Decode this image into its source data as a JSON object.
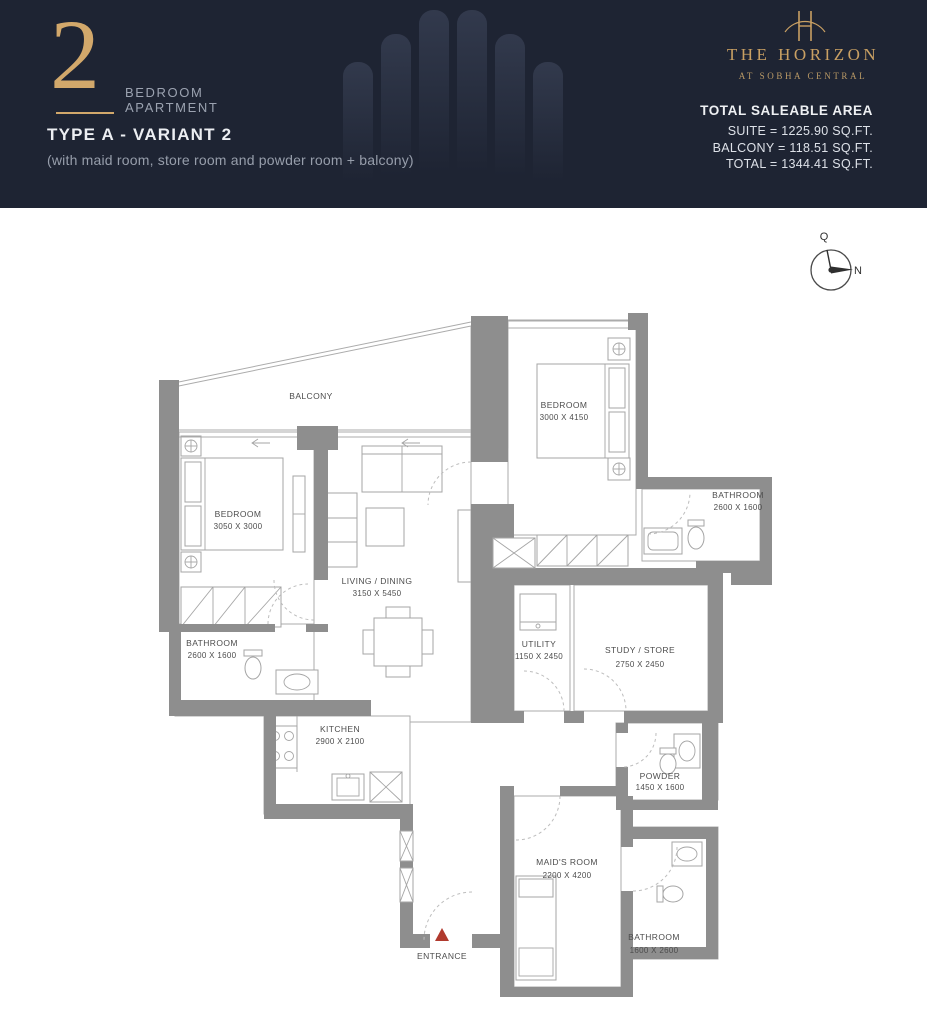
{
  "header": {
    "unit_number": "2",
    "unit_type_line1": "BEDROOM",
    "unit_type_line2": "APARTMENT",
    "variant": "TYPE A - VARIANT 2",
    "subtitle": "(with maid room, store room and powder room  + balcony)",
    "brand": {
      "name": "THE HORIZON",
      "tagline": "AT SOBHA CENTRAL"
    },
    "area": {
      "title": "TOTAL SALEABLE AREA",
      "suite": "SUITE = 1225.90 SQ.FT.",
      "balcony": "BALCONY = 118.51 SQ.FT.",
      "total": "TOTAL = 1344.41 SQ.FT."
    },
    "colors": {
      "background": "#1e2433",
      "gold": "#c9a063"
    }
  },
  "compass": {
    "top_label": "Q",
    "right_label": "N"
  },
  "plan": {
    "entrance_label": "ENTRANCE",
    "colors": {
      "wall": "#8e8e8e",
      "entrance_marker": "#b03a2e"
    },
    "rooms": [
      {
        "id": "balcony",
        "name": "BALCONY",
        "dims": ""
      },
      {
        "id": "bedroom-1",
        "name": "BEDROOM",
        "dims": "3050 X 3000"
      },
      {
        "id": "bathroom-1",
        "name": "BATHROOM",
        "dims": "2600 X 1600"
      },
      {
        "id": "living-dining",
        "name": "LIVING / DINING",
        "dims": "3150 X 5450"
      },
      {
        "id": "kitchen",
        "name": "KITCHEN",
        "dims": "2900 X 2100"
      },
      {
        "id": "bedroom-2",
        "name": "BEDROOM",
        "dims": "3000 X 4150"
      },
      {
        "id": "bathroom-2",
        "name": "BATHROOM",
        "dims": "2600 X 1600"
      },
      {
        "id": "utility",
        "name": "UTILITY",
        "dims": "1150 X 2450"
      },
      {
        "id": "study-store",
        "name": "STUDY / STORE",
        "dims": "2750 X 2450"
      },
      {
        "id": "powder",
        "name": "POWDER",
        "dims": "1450 X 1600"
      },
      {
        "id": "maids-room",
        "name": "MAID'S ROOM",
        "dims": "2200 X 4200"
      },
      {
        "id": "bathroom-3",
        "name": "BATHROOM",
        "dims": "1600 X 2600"
      }
    ]
  }
}
